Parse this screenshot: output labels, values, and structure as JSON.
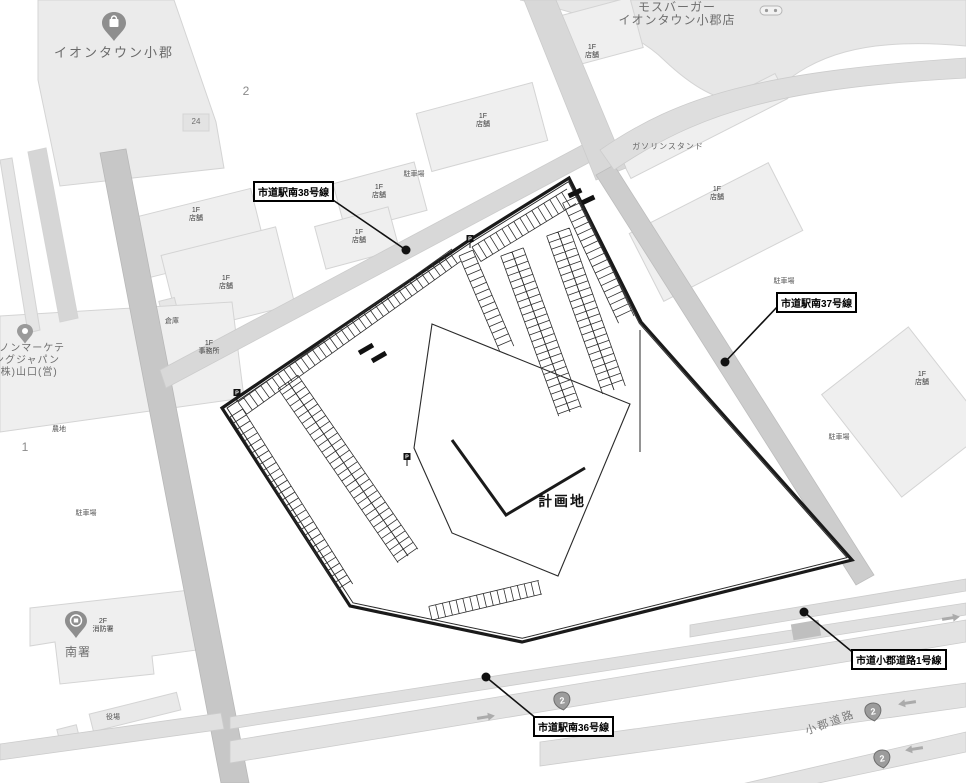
{
  "site": {
    "label": "計画地"
  },
  "road_labels": {
    "ekinan38": "市道駅南38号線",
    "ekinan37": "市道駅南37号線",
    "ekinan36": "市道駅南36号線",
    "ogori1": "市道小郡道路1号線"
  },
  "pois": {
    "iontown": "イオンタウン小郡",
    "mosburger_line1": "モスバーガー",
    "mosburger_line2": "イオンタウン小郡店",
    "canon_line1": "ヤノンマーケテ",
    "canon_line2": "ングジャパン",
    "canon_line3": "(株)山口(営)",
    "minami_station": "南署",
    "gas_station": "ガソリンスタンド",
    "ogori_road": "小郡道路"
  },
  "small_labels": {
    "floor_1f": "1F",
    "floor_2f": "2F",
    "shop": "店舗",
    "office": "事務所",
    "fire_station": "消防署",
    "parking": "駐車場",
    "warehouse": "倉庫",
    "farmland": "農地",
    "town_hall": "役場"
  },
  "numbers": {
    "block_2": "2",
    "block_24": "24",
    "block_1": "1"
  },
  "route_shield_number": "2",
  "colors": {
    "site_outline": "#1a1a1a",
    "road_fill": "#dcdcdc",
    "building_fill": "#ececec",
    "label_box_border": "#000000"
  }
}
